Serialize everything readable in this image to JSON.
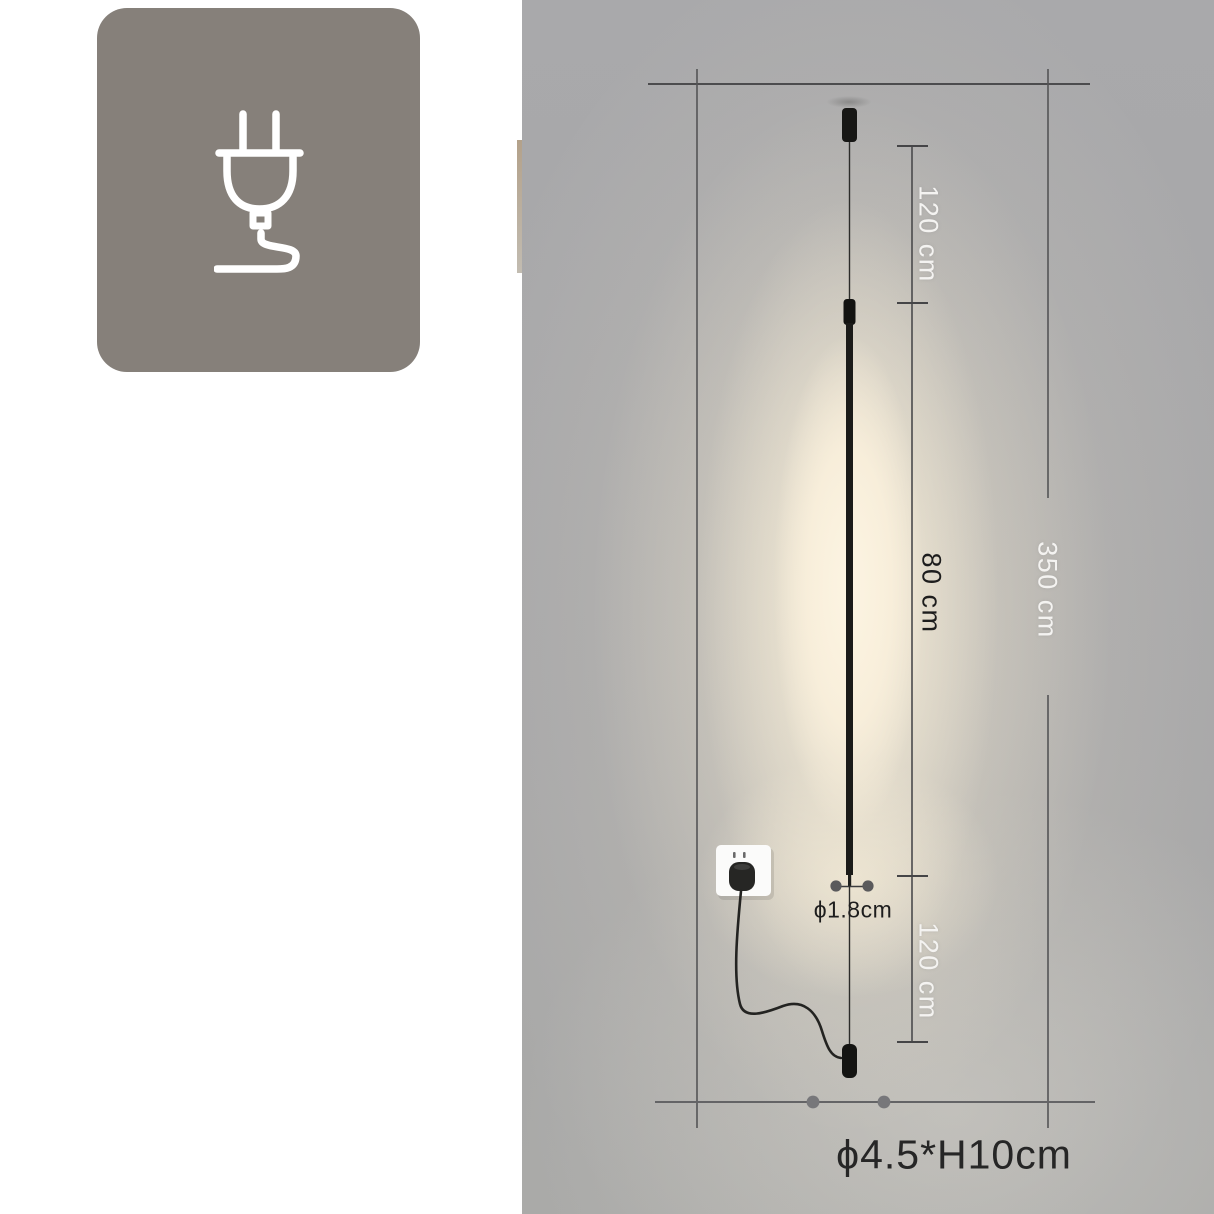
{
  "colors": {
    "page-bg": "#ffffff",
    "badge-bg": "#86807a",
    "icon-stroke": "#ffffff",
    "panel-bg": "#a7a7a9",
    "glow": "#f8eeda",
    "line": "#4c4c4e",
    "label-light": "#f4f3f1",
    "label-dark": "#1d1d1d",
    "edge-strip": "#b3a18a"
  },
  "icon_card": {
    "icon": "power-plug-icon"
  },
  "diagram": {
    "labels": {
      "upper_drop": "120 cm",
      "lamp_length": "80 cm",
      "total_drop": "350 cm",
      "lower_drop": "120 cm",
      "rod_diameter": "ϕ1.8cm",
      "canopy_size": "ϕ4.5*H10cm"
    }
  }
}
